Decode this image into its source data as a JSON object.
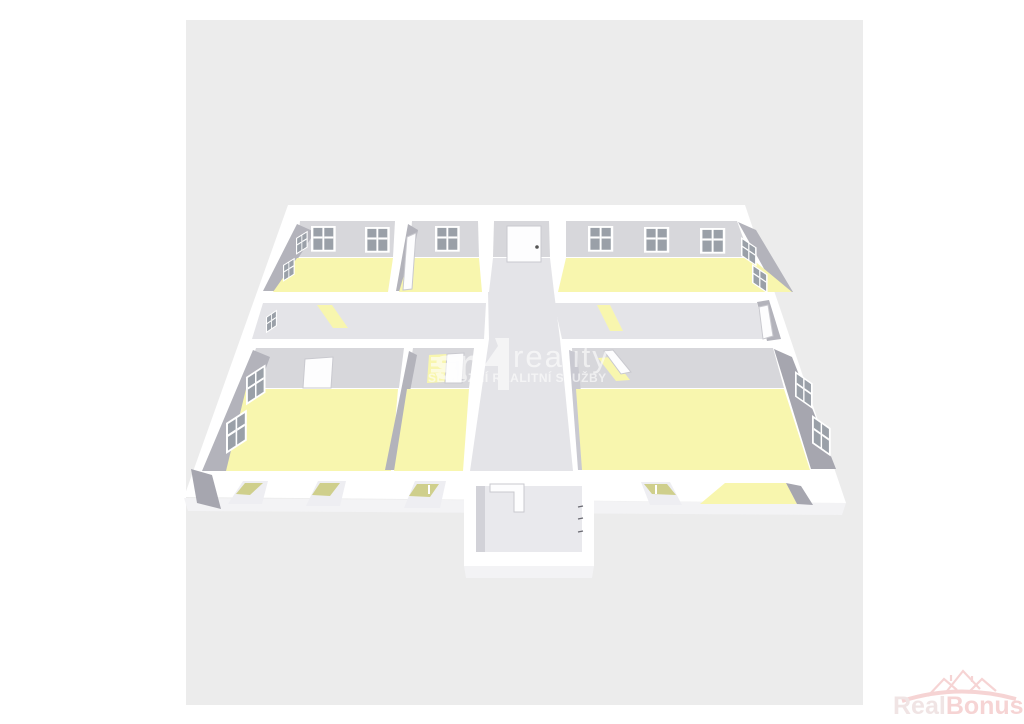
{
  "watermark": {
    "brand": "reality",
    "tagline": "SERIÓZNÍ REALITNÍ SLUŽBY",
    "logo_icon": "sn-monogram-icon"
  },
  "footer_logo": {
    "text_primary": "Real",
    "text_secondary": "Bonus",
    "tld": ".cz",
    "icon": "houses-icon"
  },
  "floorplan": {
    "view": "3d-isometric-floor-plan",
    "rooms": [
      "room-top-left",
      "room-top-middle",
      "entrance-hall",
      "room-top-right",
      "corridor-left",
      "corridor-right",
      "room-bottom-left",
      "room-bottom-middle",
      "central-corridor",
      "room-bottom-right",
      "vestibule",
      "loggia"
    ]
  },
  "colors": {
    "artboard": "#ececec",
    "floor": "#f8f6ae",
    "corridor": "#e4e4e8",
    "wall-light": "#d7d7db",
    "wall-dark": "#b3b3bb",
    "wall-darker": "#a6a6af",
    "pane": "#9aa0a8",
    "glazing": "#cfcf8c",
    "watermark": "#ffffff",
    "rb-light": "#e5cfcf",
    "rb-pink": "#f0b2b2"
  }
}
